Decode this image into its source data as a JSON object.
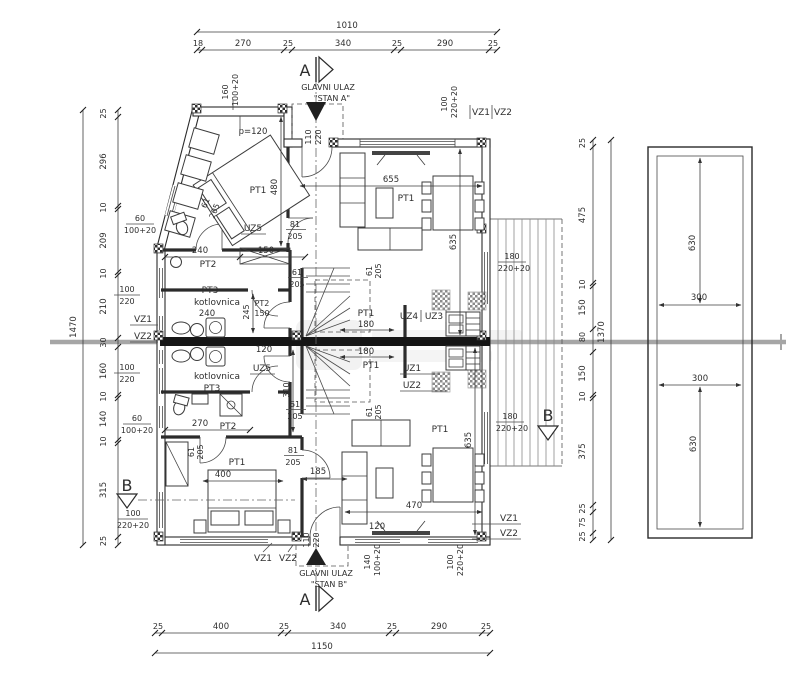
{
  "colors": {
    "line": "#3a3a3a",
    "wall_dark": "#1c1c1c",
    "section_gray": "#a6a6a6",
    "text": "#2e2e2e",
    "background": "#ffffff"
  },
  "dim_chains": {
    "top": {
      "total": "1010",
      "segments": [
        "18",
        "270",
        "25",
        "340",
        "25",
        "290",
        "25"
      ]
    },
    "bottom": {
      "total": "1150",
      "segments": [
        "25",
        "400",
        "25",
        "340",
        "25",
        "290",
        "25"
      ]
    },
    "left": {
      "total": "1470",
      "segments": [
        "25",
        "296",
        "10",
        "209",
        "10",
        "210",
        "30",
        "160",
        "10",
        "140",
        "10",
        "315",
        "25"
      ]
    },
    "right": {
      "total": "1370",
      "segments": [
        "25",
        "475",
        "10",
        "150",
        "80",
        "150",
        "10",
        "375",
        "25",
        "75",
        "25"
      ]
    }
  },
  "sections": {
    "a": "A",
    "b": "B"
  },
  "entrances": {
    "label": "GLAVNI ULAZ",
    "stan_a": "\"STAN A\"",
    "stan_b": "\"STAN B\""
  },
  "rooms": {
    "pt1": "PT1",
    "pt2": "PT2",
    "pt3": "PT3",
    "kotlovnica": "kotlovnica",
    "uz1": "UZ1",
    "uz2": "UZ2",
    "uz3": "UZ3",
    "uz4": "UZ4",
    "uz5": "UZ5",
    "vz1": "VZ1",
    "vz2": "VZ2",
    "p120": "p=120"
  },
  "dims": {
    "n60": "60",
    "n61": "61",
    "n81": "81",
    "n100": "100",
    "n110": "110",
    "n120": "120",
    "n140": "140",
    "n150": "150",
    "n160": "160",
    "n180": "180",
    "n185": "185",
    "n205": "205",
    "n220": "220",
    "n240": "240",
    "n245": "245",
    "n270": "270",
    "n300": "300",
    "n310": "310",
    "n400": "400",
    "n470": "470",
    "n480": "480",
    "n630": "630",
    "n635": "635",
    "n655": "655",
    "p220": "220+20",
    "p100": "100+20"
  }
}
